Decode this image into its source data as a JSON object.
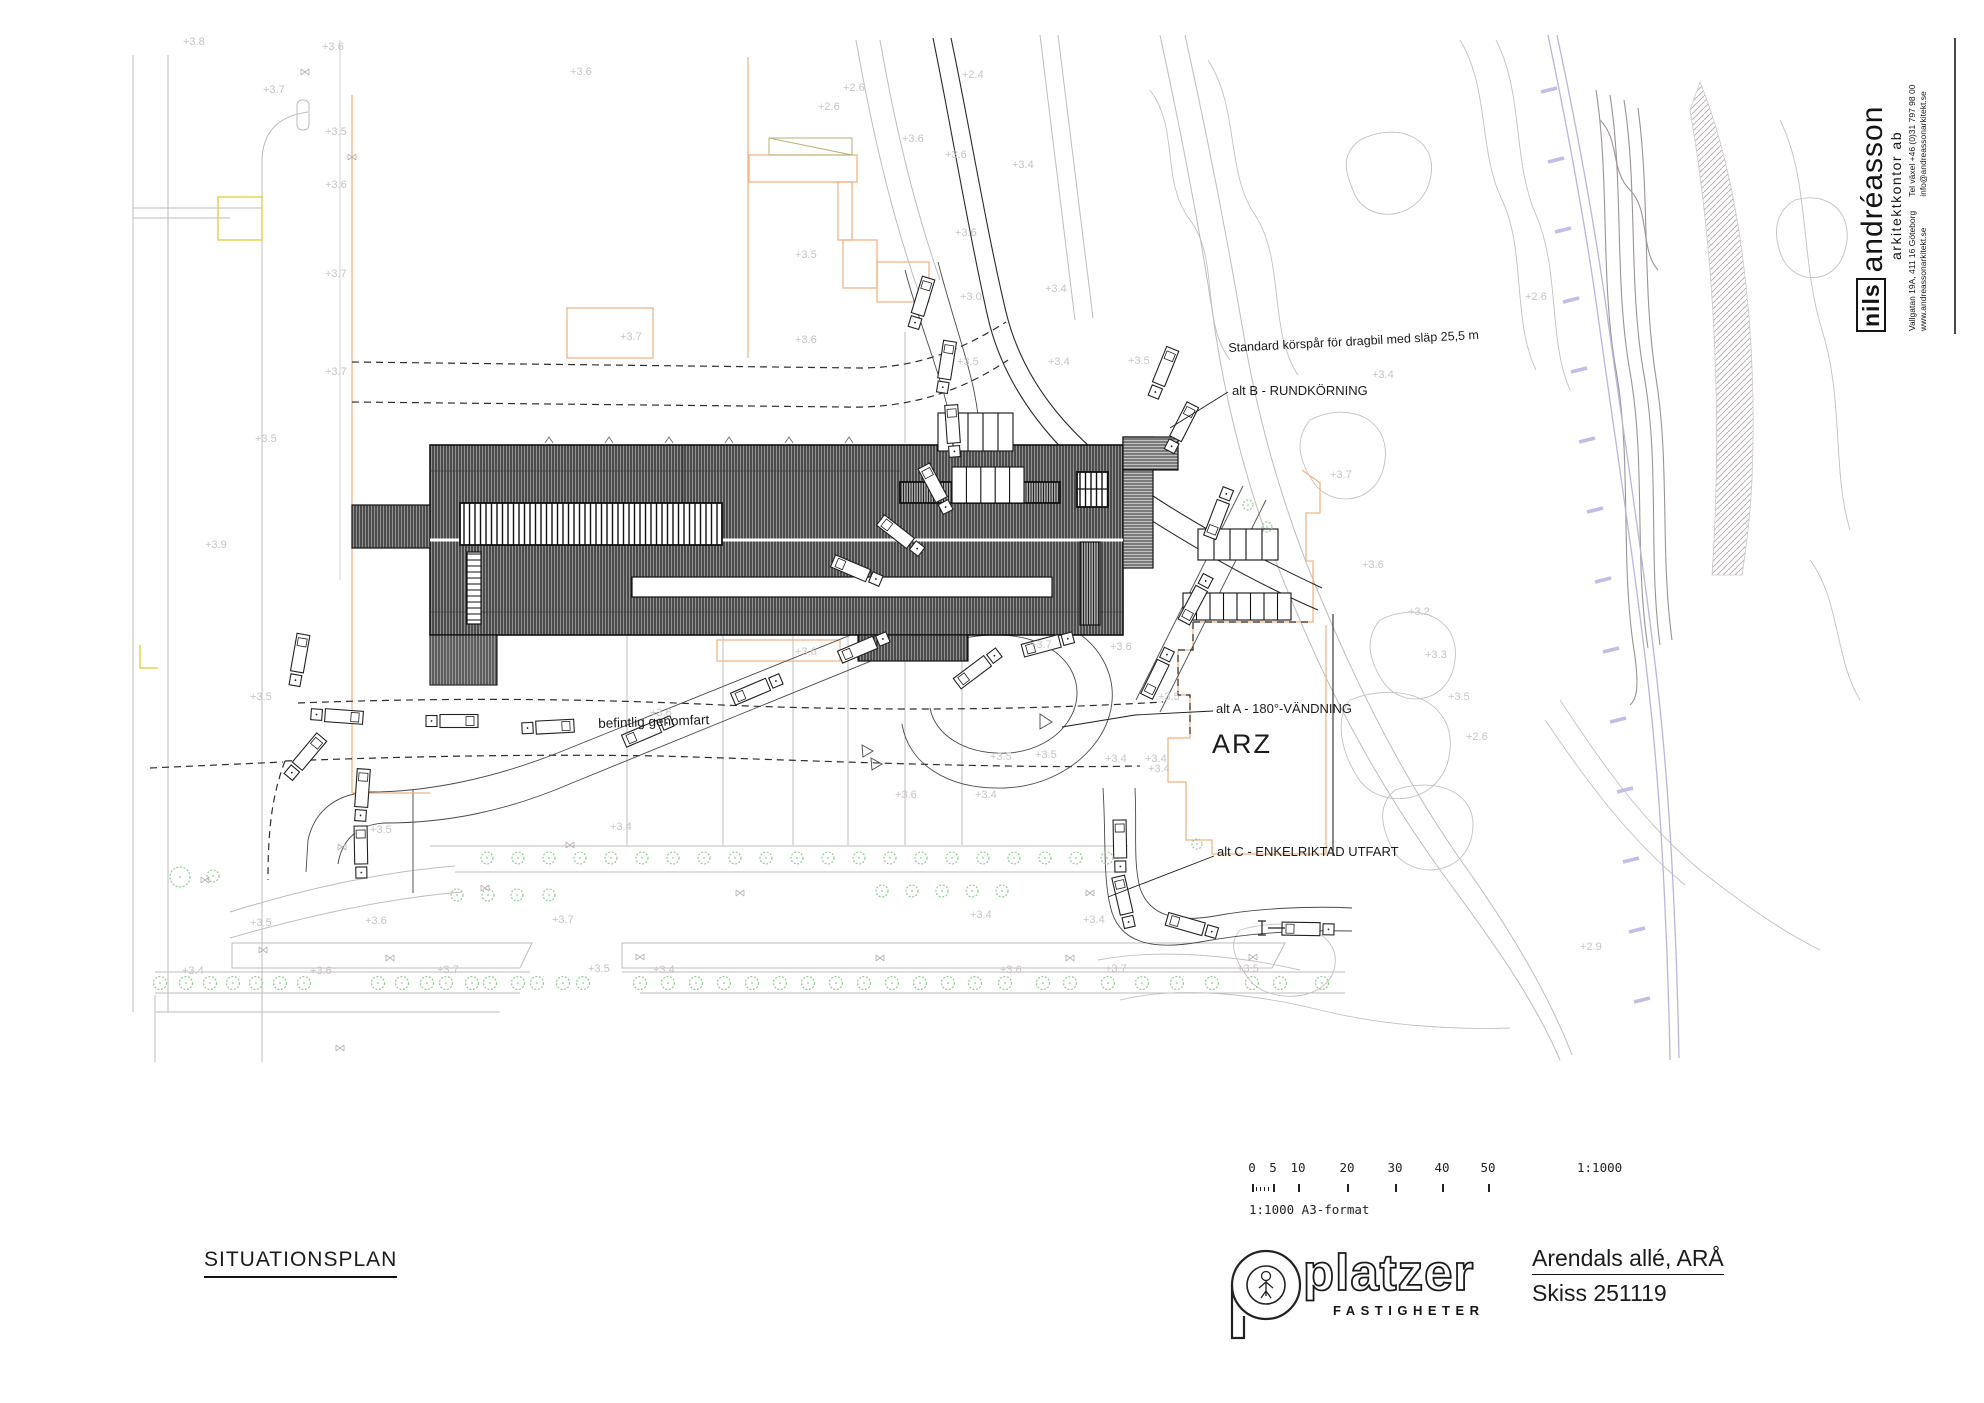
{
  "architect_block": {
    "name_prefix": "nils",
    "name_main": "andréasson",
    "subtitle": "arkitektkontor ab",
    "address_line1": "Vallgatan 19A, 411 16 Göteborg",
    "address_line2": "www.andreassonarkitekt.se",
    "contact_line1": "Tel växel +46 (0)31 797 98 00",
    "contact_line2": "info@andreassonarkitekt.se"
  },
  "plan_labels": {
    "standard_korspar": "Standard körspår för dragbil med släp 25,5 m",
    "alt_b": "alt B - RUNDKÖRNING",
    "alt_a": "alt A - 180°-VÄNDNING",
    "arz": "ARZ",
    "alt_c": "alt C - ENKELRIKTAD UTFART",
    "befintlig": "befintlig genomfart"
  },
  "spot_elevations": [
    [
      183,
      45,
      "+3.8"
    ],
    [
      263,
      93,
      "+3.7"
    ],
    [
      322,
      50,
      "+3.6"
    ],
    [
      325,
      135,
      "+3.5"
    ],
    [
      325,
      188,
      "+3.6"
    ],
    [
      325,
      277,
      "+3.7"
    ],
    [
      325,
      375,
      "+3.7"
    ],
    [
      255,
      442,
      "+3.5"
    ],
    [
      205,
      548,
      "+3.9"
    ],
    [
      250,
      700,
      "+3.5"
    ],
    [
      570,
      75,
      "+3.6"
    ],
    [
      962,
      78,
      "+2.4"
    ],
    [
      843,
      91,
      "+2.6"
    ],
    [
      818,
      110,
      "+2.6"
    ],
    [
      902,
      142,
      "+3.6"
    ],
    [
      945,
      158,
      "+3.6"
    ],
    [
      1012,
      168,
      "+3.4"
    ],
    [
      955,
      236,
      "+3.6"
    ],
    [
      795,
      258,
      "+3.5"
    ],
    [
      960,
      300,
      "+3.0"
    ],
    [
      620,
      340,
      "+3.7"
    ],
    [
      795,
      343,
      "+3.6"
    ],
    [
      1045,
      292,
      "+3.4"
    ],
    [
      957,
      365,
      "+3.5"
    ],
    [
      1128,
      364,
      "+3.5"
    ],
    [
      1048,
      365,
      "+3.4"
    ],
    [
      1372,
      378,
      "+3.4"
    ],
    [
      1330,
      478,
      "+3.7"
    ],
    [
      1362,
      568,
      "+3.6"
    ],
    [
      1408,
      615,
      "+3.2"
    ],
    [
      1425,
      658,
      "+3.3"
    ],
    [
      1448,
      700,
      "+3.5"
    ],
    [
      1158,
      700,
      "+3.5"
    ],
    [
      1148,
      772,
      "+3.4"
    ],
    [
      1466,
      740,
      "+2.6"
    ],
    [
      795,
      655,
      "+3.6"
    ],
    [
      1030,
      648,
      "+3.7"
    ],
    [
      1110,
      650,
      "+3.6"
    ],
    [
      990,
      760,
      "+3.5"
    ],
    [
      1035,
      758,
      "+3.5"
    ],
    [
      1105,
      762,
      "+3.4"
    ],
    [
      1145,
      762,
      "+3.4"
    ],
    [
      895,
      798,
      "+3.6"
    ],
    [
      975,
      798,
      "+3.4"
    ],
    [
      650,
      716,
      "+3.6"
    ],
    [
      370,
      833,
      "+3.5"
    ],
    [
      610,
      830,
      "+3.4"
    ],
    [
      250,
      926,
      "+3.5"
    ],
    [
      365,
      924,
      "+3.6"
    ],
    [
      552,
      923,
      "+3.7"
    ],
    [
      182,
      974,
      "+3.4"
    ],
    [
      310,
      974,
      "+3.6"
    ],
    [
      437,
      973,
      "+3.7"
    ],
    [
      588,
      972,
      "+3.5"
    ],
    [
      653,
      973,
      "+3.4"
    ],
    [
      970,
      918,
      "+3.4"
    ],
    [
      1083,
      923,
      "+3.4"
    ],
    [
      1000,
      973,
      "+3.6"
    ],
    [
      1105,
      972,
      "+3.7"
    ],
    [
      1237,
      972,
      "+3.5"
    ],
    [
      1525,
      300,
      "+2.6"
    ],
    [
      1580,
      950,
      "+2.9"
    ]
  ],
  "trees": [
    [
      487,
      858,
      6
    ],
    [
      518,
      858,
      6
    ],
    [
      549,
      858,
      6
    ],
    [
      580,
      858,
      6
    ],
    [
      611,
      858,
      6
    ],
    [
      642,
      858,
      6
    ],
    [
      673,
      858,
      6
    ],
    [
      704,
      858,
      6
    ],
    [
      735,
      858,
      6
    ],
    [
      766,
      858,
      6
    ],
    [
      797,
      858,
      6
    ],
    [
      828,
      858,
      6
    ],
    [
      859,
      858,
      6
    ],
    [
      890,
      858,
      6
    ],
    [
      921,
      858,
      6
    ],
    [
      952,
      858,
      6
    ],
    [
      983,
      858,
      6
    ],
    [
      1014,
      858,
      6
    ],
    [
      1045,
      858,
      6
    ],
    [
      1076,
      858,
      6
    ],
    [
      1107,
      858,
      6
    ],
    [
      457,
      895,
      6
    ],
    [
      488,
      895,
      6
    ],
    [
      517,
      895,
      6
    ],
    [
      549,
      895,
      6
    ],
    [
      882,
      891,
      6
    ],
    [
      912,
      891,
      6
    ],
    [
      942,
      891,
      6
    ],
    [
      972,
      891,
      6
    ],
    [
      1002,
      891,
      6
    ],
    [
      160,
      983,
      6.5
    ],
    [
      186,
      983,
      6.5
    ],
    [
      210,
      983,
      6.5
    ],
    [
      233,
      983,
      6.5
    ],
    [
      256,
      983,
      6.5
    ],
    [
      280,
      983,
      6.5
    ],
    [
      304,
      983,
      6.5
    ],
    [
      378,
      983,
      6.5
    ],
    [
      402,
      983,
      6.5
    ],
    [
      427,
      983,
      6.5
    ],
    [
      446,
      983,
      6.5
    ],
    [
      472,
      983,
      6.5
    ],
    [
      490,
      983,
      6.5
    ],
    [
      518,
      983,
      6.5
    ],
    [
      537,
      983,
      6.5
    ],
    [
      563,
      983,
      6.5
    ],
    [
      583,
      983,
      6.5
    ],
    [
      640,
      983,
      6.5
    ],
    [
      668,
      983,
      6.5
    ],
    [
      696,
      983,
      6.5
    ],
    [
      724,
      983,
      6.5
    ],
    [
      752,
      983,
      6.5
    ],
    [
      780,
      983,
      6.5
    ],
    [
      808,
      983,
      6.5
    ],
    [
      836,
      983,
      6.5
    ],
    [
      864,
      983,
      6.5
    ],
    [
      892,
      983,
      6.5
    ],
    [
      920,
      983,
      6.5
    ],
    [
      948,
      983,
      6.5
    ],
    [
      975,
      983,
      6.5
    ],
    [
      1005,
      983,
      6.5
    ],
    [
      1043,
      983,
      6.5
    ],
    [
      1070,
      983,
      6.5
    ],
    [
      1108,
      983,
      6.5
    ],
    [
      1142,
      983,
      6.5
    ],
    [
      1177,
      983,
      6.5
    ],
    [
      1212,
      983,
      6.5
    ],
    [
      1252,
      983,
      6.5
    ],
    [
      1280,
      983,
      6.5
    ],
    [
      1322,
      983,
      6.5
    ],
    [
      180,
      877,
      10
    ],
    [
      213,
      876,
      6
    ],
    [
      1248,
      505,
      5
    ],
    [
      1267,
      527,
      5
    ],
    [
      1197,
      844,
      5
    ]
  ],
  "trucks": [
    [
      921,
      303,
      197
    ],
    [
      946,
      367,
      189
    ],
    [
      953,
      431,
      176
    ],
    [
      936,
      489,
      152
    ],
    [
      901,
      536,
      128
    ],
    [
      857,
      571,
      113
    ],
    [
      648,
      731,
      67
    ],
    [
      757,
      689,
      67
    ],
    [
      864,
      647,
      67
    ],
    [
      978,
      668,
      53
    ],
    [
      1048,
      644,
      75
    ],
    [
      337,
      716,
      274
    ],
    [
      452,
      721,
      270
    ],
    [
      548,
      727,
      267
    ],
    [
      299,
      660,
      190
    ],
    [
      305,
      757,
      220
    ],
    [
      362,
      795,
      184
    ],
    [
      361,
      852,
      179
    ],
    [
      1120,
      846,
      179
    ],
    [
      1124,
      902,
      167
    ],
    [
      1192,
      926,
      106
    ],
    [
      1308,
      929,
      91
    ],
    [
      1158,
      673,
      26
    ],
    [
      1196,
      599,
      28
    ],
    [
      1219,
      513,
      21
    ],
    [
      1163,
      373,
      202
    ],
    [
      1181,
      428,
      207
    ]
  ],
  "stalls": [
    [
      938,
      413,
      75,
      38,
      5
    ],
    [
      952,
      467,
      72,
      36,
      5
    ],
    [
      1198,
      529,
      80,
      31,
      5
    ],
    [
      1183,
      593,
      108,
      27,
      8
    ]
  ],
  "xmarks": [
    [
      305,
      72
    ],
    [
      352,
      157
    ],
    [
      263,
      950
    ],
    [
      390,
      958
    ],
    [
      342,
      847
    ],
    [
      570,
      845
    ],
    [
      640,
      957
    ],
    [
      740,
      893
    ],
    [
      880,
      958
    ],
    [
      1070,
      958
    ],
    [
      1090,
      893
    ],
    [
      1253,
      957
    ],
    [
      205,
      880
    ],
    [
      340,
      1048
    ],
    [
      485,
      888
    ]
  ],
  "sleepers": [
    [
      1549,
      90
    ],
    [
      1556,
      160
    ],
    [
      1563,
      230
    ],
    [
      1571,
      300
    ],
    [
      1579,
      370
    ],
    [
      1587,
      440
    ],
    [
      1595,
      510
    ],
    [
      1603,
      580
    ],
    [
      1611,
      650
    ],
    [
      1618,
      720
    ],
    [
      1625,
      790
    ],
    [
      1631,
      860
    ],
    [
      1637,
      930
    ],
    [
      1642,
      1000
    ]
  ],
  "scalebar": {
    "numbers": [
      [
        "0",
        1252
      ],
      [
        "5",
        1273
      ],
      [
        "10",
        1298
      ],
      [
        "20",
        1347
      ],
      [
        "30",
        1395
      ],
      [
        "40",
        1442
      ],
      [
        "50",
        1488
      ]
    ],
    "minor_ticks": [
      1256,
      1260,
      1264,
      1268
    ],
    "ratio": "1:1000",
    "ratio_x": 1577,
    "note": "1:1000 A3-format"
  },
  "title_block": {
    "drawing_title": "SITUATIONSPLAN",
    "logo_word": "platzer",
    "logo_sub": "FASTIGHETER",
    "project_title": "Arendals allé, ARÅ",
    "sketch_no": "Skiss 251119"
  },
  "colors": {
    "accent_orange": "#f2b488",
    "accent_yellow": "#e5d44e",
    "tree_green": "#8fce8f",
    "railway_lavender": "#bcb4de",
    "faint_gray": "#c6c0c0",
    "building_dark": "#6b6b6b",
    "spot_gray": "#c9c3c3"
  }
}
